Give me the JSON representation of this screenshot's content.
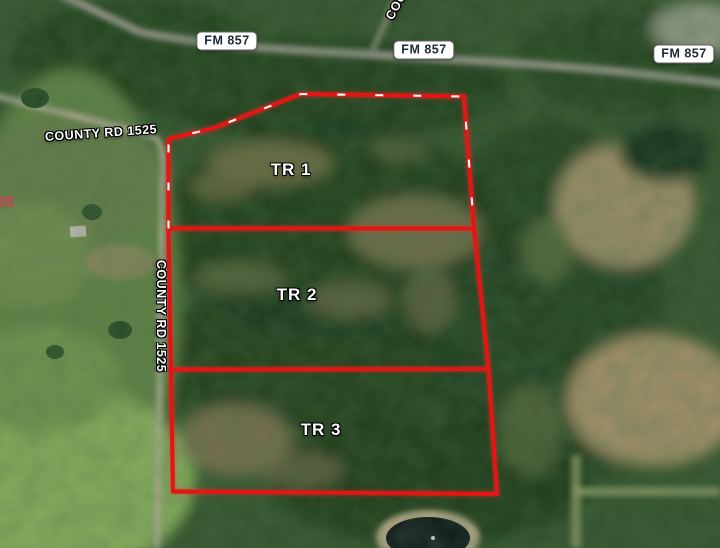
{
  "map_title": "Satellite parcel map with three outlined tracts",
  "road_shields": [
    {
      "label": "FM 857"
    },
    {
      "label": "FM 857"
    },
    {
      "label": "FM 857"
    }
  ],
  "road_names": {
    "county_horizontal": "COUNTY RD 1525",
    "county_vertical": "COUNTY RD 1525",
    "county_partial": "COU"
  },
  "tracts": [
    {
      "label": "TR 1"
    },
    {
      "label": "TR 2"
    },
    {
      "label": "TR 3"
    }
  ],
  "colors": {
    "boundary_red": "#e31414",
    "dash_white": "#ffffff",
    "shield_bg": "#ffffff",
    "shield_border": "#636363",
    "shield_text": "#1f2937",
    "road_label_text": "#ffffff"
  }
}
